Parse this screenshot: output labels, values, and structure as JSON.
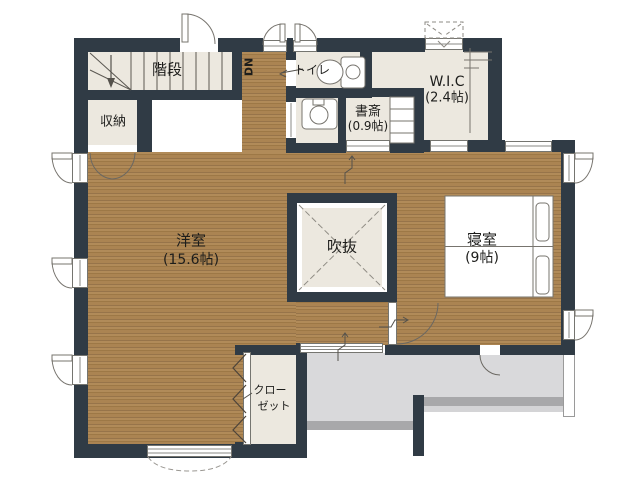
{
  "plan_title": "2F floor plan",
  "rooms": {
    "stairs": "階段",
    "dn": "DN",
    "storage": "収納",
    "toilet": "トイレ",
    "wic_name": "W.I.C",
    "wic_area": "(2.4帖)",
    "study_name": "書斎",
    "study_area": "(0.9帖)",
    "western_name": "洋室",
    "western_area": "(15.6帖)",
    "void": "吹抜",
    "bedroom_name": "寝室",
    "bedroom_area": "(9帖)",
    "closet_line1": "クロー",
    "closet_line2": "ゼット"
  },
  "colors": {
    "wall": "#303b45",
    "wood_floor": "#ab8452",
    "room_floor": "#ece8df",
    "balcony": "#d9d9db",
    "railing": "#a8a8aa"
  }
}
